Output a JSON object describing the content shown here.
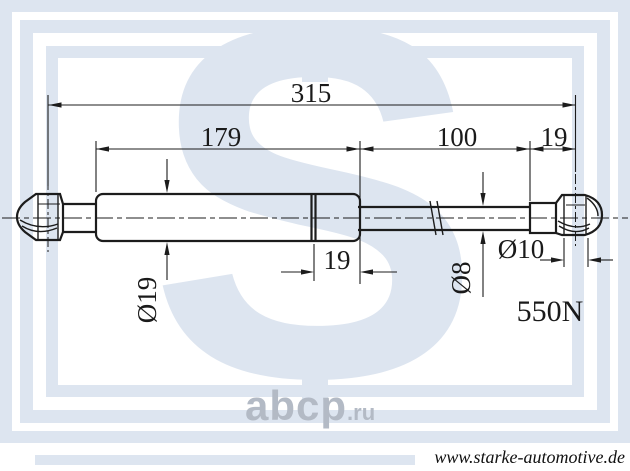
{
  "dimensions": {
    "total_length": "315",
    "body_length": "179",
    "rod_length": "100",
    "end_offset": "19",
    "collar_length": "19",
    "body_diameter": "Ø19",
    "rod_diameter": "Ø8",
    "eye_diameter": "Ø10",
    "force": "550N"
  },
  "watermarks": {
    "logo_letter": "S",
    "abcp_name": "abcp",
    "abcp_tld": ".ru"
  },
  "footer": {
    "website": "www.starke-automotive.de"
  },
  "colors": {
    "line": "#1c1c1c",
    "watermark_blue": "#dde5f0",
    "abcp_gray": "#b3bac5"
  }
}
